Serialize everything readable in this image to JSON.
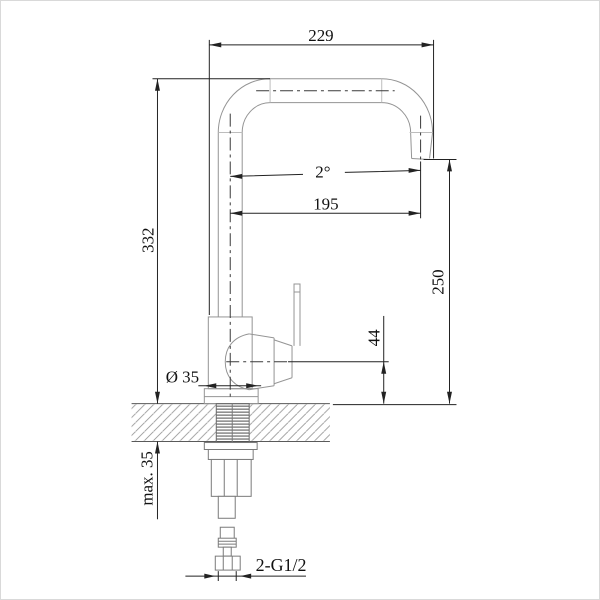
{
  "drawing": {
    "title": "Kitchen faucet installation dimension drawing",
    "view": "side elevation with counter cross-section",
    "labels": {
      "overall_width": "229",
      "overall_height": "332",
      "spout_angle": "2°",
      "spout_reach": "195",
      "outlet_height": "250",
      "handle_center_height": "44",
      "base_diameter": "Ø 35",
      "max_deck_thickness": "max. 35",
      "connection_thread": "2-G1/2"
    },
    "colors": {
      "dimension_line": "#222222",
      "outline": "#949494",
      "centerline": "#3a3a3a",
      "hatch": "#9a9a9a",
      "background": "#ffffff"
    }
  }
}
